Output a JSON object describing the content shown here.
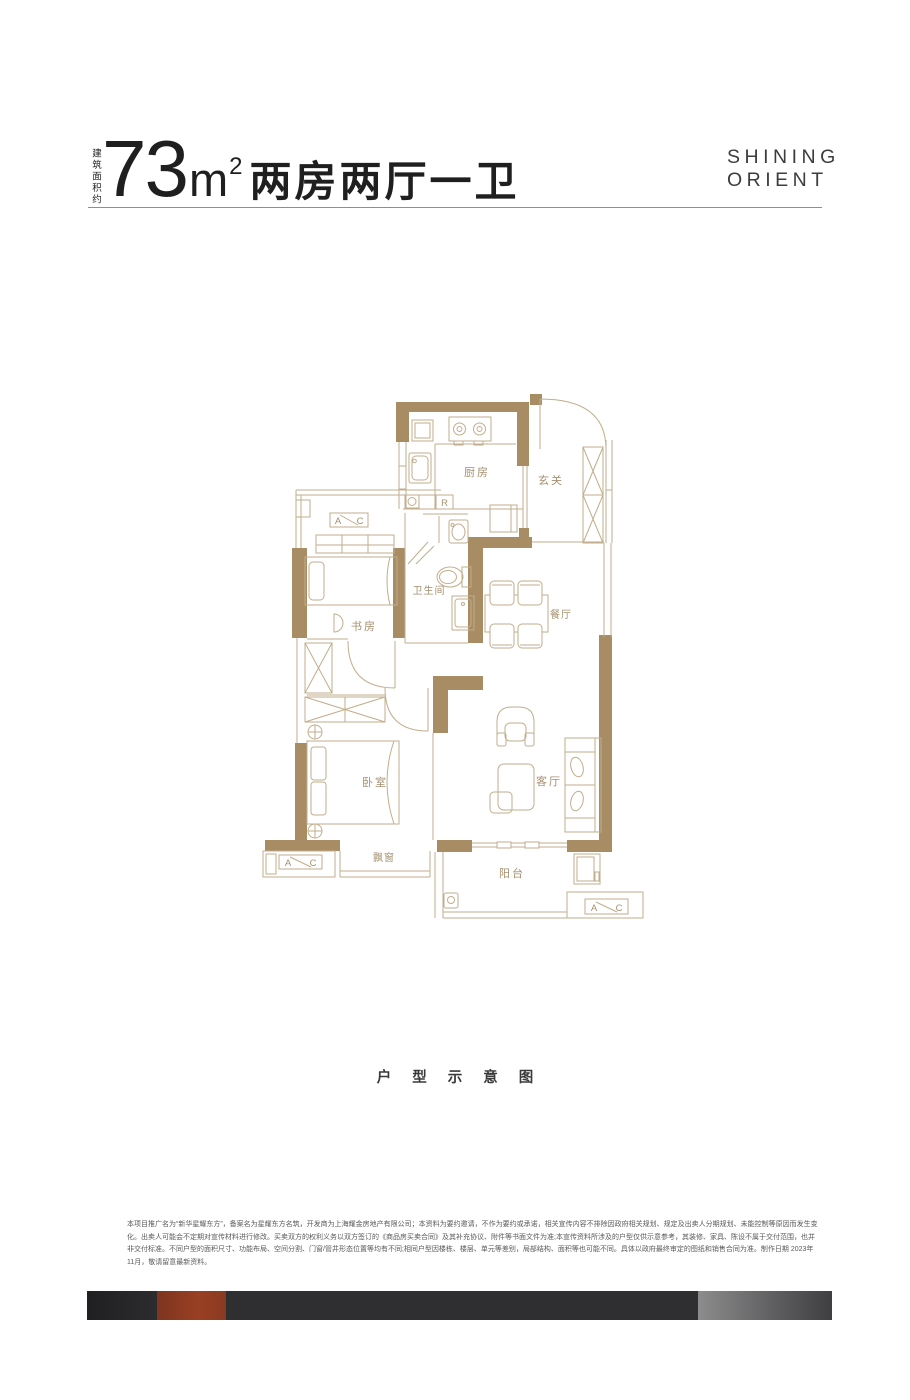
{
  "header": {
    "area_label_vertical": "建筑面积约",
    "area_number": "73",
    "area_unit": "m",
    "area_exponent": "2",
    "layout_text": "两房两厅一卫"
  },
  "brand": {
    "line1": "SHINING",
    "line2": "ORIENT"
  },
  "floorplan": {
    "rooms": {
      "kitchen": "厨房",
      "foyer": "玄关",
      "bathroom": "卫生间",
      "study": "书房",
      "dining": "餐厅",
      "bedroom": "卧室",
      "living": "客厅",
      "bay_window": "飘窗",
      "balcony": "阳台"
    },
    "fridge_label": "R",
    "ac_box": {
      "left": "A",
      "right": "C"
    }
  },
  "caption": "户型示意图",
  "disclaimer": {
    "line1": "本项目推广名为“新华星耀东方”，备案名为星耀东方名筑，开发商为上海耀金房地产有限公司；本资料为要约邀请，不作为要约或承诺，相关宣传内容不排除因政府相关规划、规定及出卖人分期规划、未能控制等原因而发生变",
    "line2": "化。出卖人可能会不定期对宣传材料进行修改。买卖双方的权利义务以双方签订的《商品房买卖合同》及其补充协议、附件等书面文件为准;本宣传资料所涉及的户型仅供示意参考，其装修、家具、陈设不属于交付范围，也并",
    "line3": "非交付标准。不同户型的面积尺寸、功能布局、空间分割、门窗/管井形态位置等均有不同;相同户型因楼栋、楼层、单元等差别，局部结构、面积等也可能不同。具体以政府最终审定的图纸和销售合同为准。制作日期 2023年",
    "line4": "11月，敬请留意最新资料。"
  },
  "colors": {
    "wall": "#a78c64",
    "line": "#c2ad8c",
    "label": "#a5906f",
    "ink": "#1f1f1f",
    "brand_ink": "#3d3d3d",
    "rule": "#8f8f8f",
    "disclaimer_ink": "#5a5a5a",
    "bar_bg": "#2f2f31",
    "bar_red": "#9a3f23",
    "bar_light": "#8c8c8c"
  }
}
